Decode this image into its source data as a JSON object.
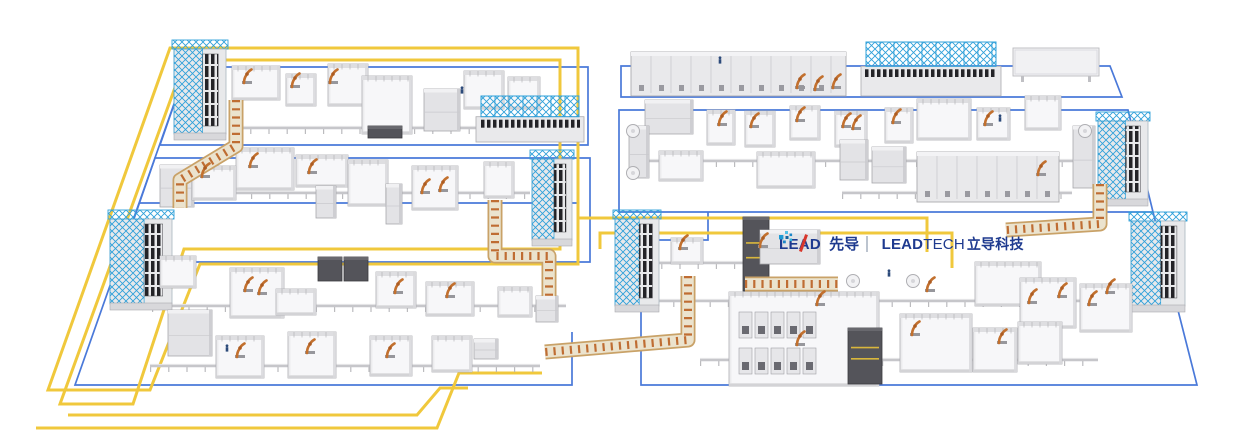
{
  "scene": {
    "width": 1235,
    "height": 441,
    "background": "#FFFFFF"
  },
  "colors": {
    "yellow_path": "#F0C83C",
    "blue_boundary": "#4A79D9",
    "cyan_truss": "#2FA0D9",
    "machine_light": "#ECECEE",
    "machine_mid": "#E3E3E6",
    "machine_edge": "#AFAFB4",
    "machine_floor": "#F7F7F9",
    "dark_unit": "#54545A",
    "dark_slat": "#232327",
    "robot_orange": "#C2702E",
    "robot_joint": "#AC5C22",
    "conveyor_base": "#EBE3CE",
    "conveyor_edge": "#C9A268",
    "conveyor_rung": "#BF6D33",
    "rail_gray": "#C6C6CA",
    "post_gray": "#B4B4B8",
    "human_blue": "#2C4A7A",
    "logo_navy": "#1E3A8F",
    "logo_red": "#D8362B"
  },
  "logo": {
    "lead_l1": "LE",
    "lead_a": "A",
    "lead_l2": "D",
    "lead_cn": "先导",
    "lt_bold": "LEAD",
    "lt_reg": "TECH",
    "lt_cn": "立导科技",
    "dots": [
      {
        "x": 6,
        "y": 0,
        "s": 3,
        "c": "#4FC0E8"
      },
      {
        "x": 10.5,
        "y": 2.5,
        "s": 2.6,
        "c": "#1C86C8"
      },
      {
        "x": 0,
        "y": 4,
        "s": 4.4,
        "c": "#1E9AD4"
      },
      {
        "x": 6.5,
        "y": 5,
        "s": 3,
        "c": "#15639F"
      },
      {
        "x": 10.5,
        "y": 7.5,
        "s": 2.6,
        "c": "#2FB4DD"
      },
      {
        "x": 4,
        "y": 9.5,
        "s": 2.8,
        "c": "#1C86C8"
      }
    ]
  },
  "yellow_paths": [
    "M170,48 H578 V264 H200 L150,390 H48 Z",
    "M185,60 H560 V249 H184 L133,404 H60 Z",
    "M578,218 H927 V252",
    "M600,249 V233 H952 V268",
    "M68,415 H417 L440,388 H468",
    "M36,428 H437 L459,373 H542"
  ],
  "blue_paths": [
    "M187,67 H588 V145 H160 Z",
    "M155,158 H590 V262 H119 Z",
    "M139,203 H578",
    "M187,67 L75,385 H572 V332",
    "M621,66 H1110 L1122,97 H621 Z",
    "M619,110 H1128 L1153,212 H619 Z",
    "M641,240 H708 V212",
    "M641,240 V385 H1197 L1153,212"
  ],
  "machines": [
    [
      174,
      46,
      52,
      94,
      "rack"
    ],
    [
      232,
      66,
      48,
      34,
      "cell"
    ],
    [
      286,
      74,
      30,
      32,
      "cell"
    ],
    [
      328,
      64,
      40,
      42,
      "cell"
    ],
    [
      362,
      76,
      50,
      58,
      "cell"
    ],
    [
      368,
      126,
      34,
      12,
      "dark"
    ],
    [
      424,
      89,
      36,
      42,
      "box"
    ],
    [
      464,
      71,
      40,
      38,
      "cell"
    ],
    [
      508,
      77,
      32,
      32,
      "cell"
    ],
    [
      476,
      96,
      108,
      46,
      "truss"
    ],
    [
      160,
      165,
      34,
      42,
      "box"
    ],
    [
      192,
      166,
      44,
      34,
      "cell"
    ],
    [
      236,
      148,
      58,
      42,
      "cell"
    ],
    [
      296,
      155,
      52,
      32,
      "cell"
    ],
    [
      348,
      160,
      40,
      46,
      "cell"
    ],
    [
      316,
      186,
      20,
      32,
      "box"
    ],
    [
      386,
      184,
      16,
      40,
      "box"
    ],
    [
      412,
      166,
      46,
      44,
      "cell"
    ],
    [
      484,
      162,
      30,
      36,
      "cell"
    ],
    [
      532,
      156,
      40,
      90,
      "rack"
    ],
    [
      110,
      216,
      62,
      94,
      "rack"
    ],
    [
      160,
      256,
      36,
      32,
      "cell"
    ],
    [
      168,
      310,
      44,
      46,
      "box"
    ],
    [
      230,
      268,
      54,
      50,
      "cell"
    ],
    [
      276,
      289,
      40,
      26,
      "cell"
    ],
    [
      318,
      257,
      24,
      24,
      "dark"
    ],
    [
      344,
      257,
      24,
      24,
      "dark"
    ],
    [
      376,
      272,
      40,
      36,
      "cell"
    ],
    [
      426,
      282,
      48,
      34,
      "cell"
    ],
    [
      498,
      287,
      34,
      30,
      "cell"
    ],
    [
      536,
      296,
      22,
      26,
      "box"
    ],
    [
      216,
      336,
      48,
      42,
      "cell"
    ],
    [
      288,
      332,
      48,
      46,
      "cell"
    ],
    [
      370,
      336,
      42,
      40,
      "cell"
    ],
    [
      432,
      336,
      40,
      36,
      "cell"
    ],
    [
      474,
      339,
      24,
      20,
      "box"
    ],
    [
      631,
      52,
      215,
      44,
      "long"
    ],
    [
      861,
      42,
      140,
      54,
      "truss"
    ],
    [
      1013,
      48,
      86,
      28,
      "panel"
    ],
    [
      645,
      100,
      48,
      34,
      "box"
    ],
    [
      707,
      110,
      28,
      35,
      "cell"
    ],
    [
      745,
      111,
      30,
      36,
      "cell"
    ],
    [
      790,
      106,
      30,
      34,
      "cell"
    ],
    [
      835,
      111,
      32,
      36,
      "cell"
    ],
    [
      885,
      108,
      28,
      35,
      "cell"
    ],
    [
      917,
      99,
      54,
      41,
      "cell"
    ],
    [
      977,
      108,
      33,
      32,
      "cell"
    ],
    [
      1025,
      96,
      36,
      34,
      "cell"
    ],
    [
      629,
      126,
      20,
      52,
      "box"
    ],
    [
      659,
      151,
      44,
      30,
      "cell"
    ],
    [
      757,
      152,
      58,
      36,
      "cell"
    ],
    [
      840,
      140,
      28,
      40,
      "box"
    ],
    [
      872,
      147,
      34,
      36,
      "box"
    ],
    [
      917,
      152,
      142,
      50,
      "long"
    ],
    [
      1073,
      126,
      22,
      62,
      "box"
    ],
    [
      1098,
      118,
      50,
      88,
      "rack"
    ],
    [
      615,
      216,
      44,
      96,
      "rack"
    ],
    [
      671,
      238,
      32,
      26,
      "cell"
    ],
    [
      743,
      217,
      26,
      74,
      "dark"
    ],
    [
      760,
      230,
      60,
      34,
      "box"
    ],
    [
      729,
      292,
      150,
      94,
      "cell"
    ],
    [
      737,
      308,
      84,
      72,
      "grid"
    ],
    [
      848,
      328,
      34,
      56,
      "dark"
    ],
    [
      900,
      314,
      72,
      58,
      "cell"
    ],
    [
      975,
      262,
      66,
      44,
      "cell"
    ],
    [
      1020,
      278,
      56,
      50,
      "cell"
    ],
    [
      1080,
      284,
      52,
      48,
      "cell"
    ],
    [
      1131,
      218,
      54,
      94,
      "rack"
    ],
    [
      973,
      328,
      44,
      44,
      "cell"
    ],
    [
      1018,
      322,
      44,
      42,
      "cell"
    ]
  ],
  "conveyors": [
    [
      [
        236,
        100
      ],
      [
        236,
        146
      ],
      [
        180,
        180
      ],
      [
        180,
        208
      ]
    ],
    [
      [
        495,
        200
      ],
      [
        495,
        256
      ],
      [
        549,
        256
      ],
      [
        549,
        296
      ]
    ],
    [
      [
        688,
        276
      ],
      [
        688,
        340
      ],
      [
        545,
        352
      ]
    ],
    [
      [
        1100,
        184
      ],
      [
        1100,
        224
      ],
      [
        1006,
        230
      ]
    ],
    [
      [
        745,
        284
      ],
      [
        838,
        284
      ]
    ]
  ],
  "rails": [
    [
      232,
      128,
      540,
      128
    ],
    [
      160,
      193,
      530,
      193
    ],
    [
      152,
      306,
      566,
      306
    ],
    [
      150,
      366,
      540,
      366
    ],
    [
      643,
      161,
      1088,
      161
    ],
    [
      842,
      193,
      1072,
      193
    ],
    [
      643,
      263,
      743,
      263
    ],
    [
      655,
      301,
      1131,
      301
    ],
    [
      700,
      360,
      1098,
      360
    ]
  ],
  "robots": [
    [
      247,
      80
    ],
    [
      295,
      84
    ],
    [
      333,
      80
    ],
    [
      205,
      174
    ],
    [
      253,
      164
    ],
    [
      312,
      170
    ],
    [
      425,
      190
    ],
    [
      443,
      188
    ],
    [
      248,
      288
    ],
    [
      262,
      291
    ],
    [
      398,
      290
    ],
    [
      450,
      294
    ],
    [
      310,
      350
    ],
    [
      240,
      354
    ],
    [
      390,
      354
    ],
    [
      722,
      122
    ],
    [
      754,
      124
    ],
    [
      800,
      118
    ],
    [
      846,
      124
    ],
    [
      856,
      126
    ],
    [
      896,
      120
    ],
    [
      988,
      122
    ],
    [
      1041,
      172
    ],
    [
      683,
      246
    ],
    [
      763,
      244
    ],
    [
      820,
      302
    ],
    [
      930,
      288
    ],
    [
      1032,
      300
    ],
    [
      1062,
      294
    ],
    [
      1092,
      302
    ],
    [
      1110,
      290
    ],
    [
      915,
      332
    ],
    [
      800,
      342
    ],
    [
      1002,
      340
    ],
    [
      800,
      85
    ],
    [
      818,
      87
    ],
    [
      836,
      85
    ]
  ],
  "humans": [
    [
      720,
      63
    ],
    [
      1000,
      121
    ],
    [
      227,
      351
    ],
    [
      889,
      276
    ],
    [
      462,
      93
    ]
  ],
  "turntables": [
    [
      633,
      131
    ],
    [
      633,
      173
    ],
    [
      853,
      281
    ],
    [
      913,
      281
    ],
    [
      1085,
      131
    ]
  ]
}
